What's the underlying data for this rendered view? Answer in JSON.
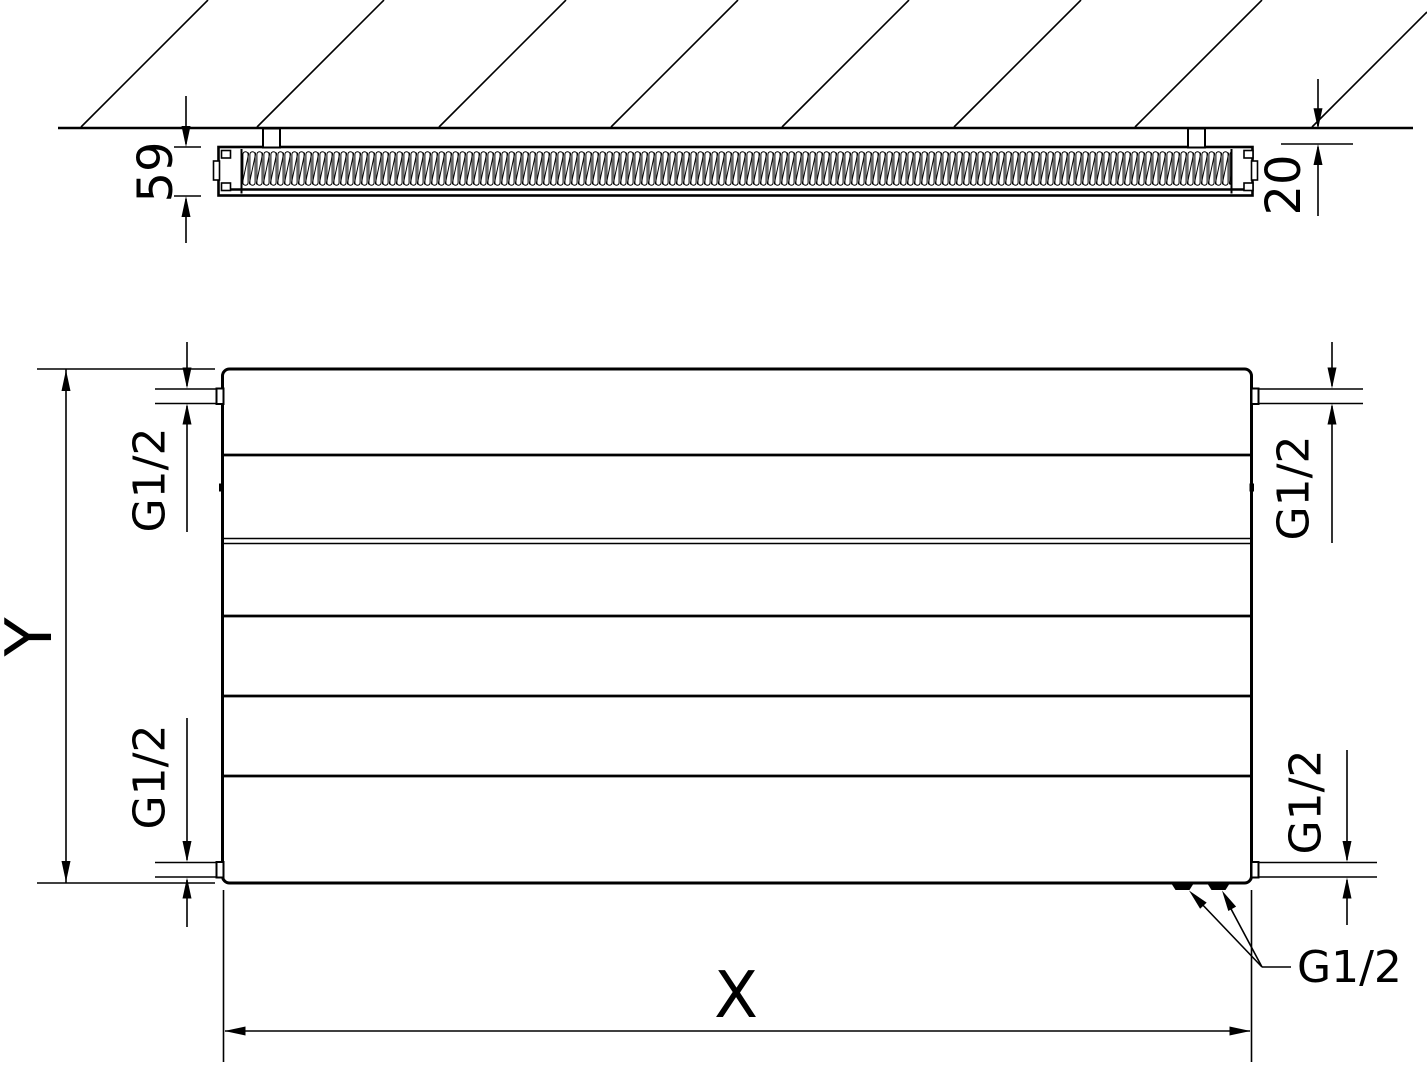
{
  "drawing": {
    "type": "radiator-technical-drawing",
    "colors": {
      "line": "#000000",
      "background": "#ffffff"
    },
    "side_view": {
      "depth_dim": "59",
      "wall_gap_dim": "20"
    },
    "front_view": {
      "height_dim": "Y",
      "width_dim": "X",
      "conn_top_left": "G1/2",
      "conn_bottom_left": "G1/2",
      "conn_top_right": "G1/2",
      "conn_bottom_right": "G1/2",
      "conn_bottom_center": "G1/2"
    }
  }
}
